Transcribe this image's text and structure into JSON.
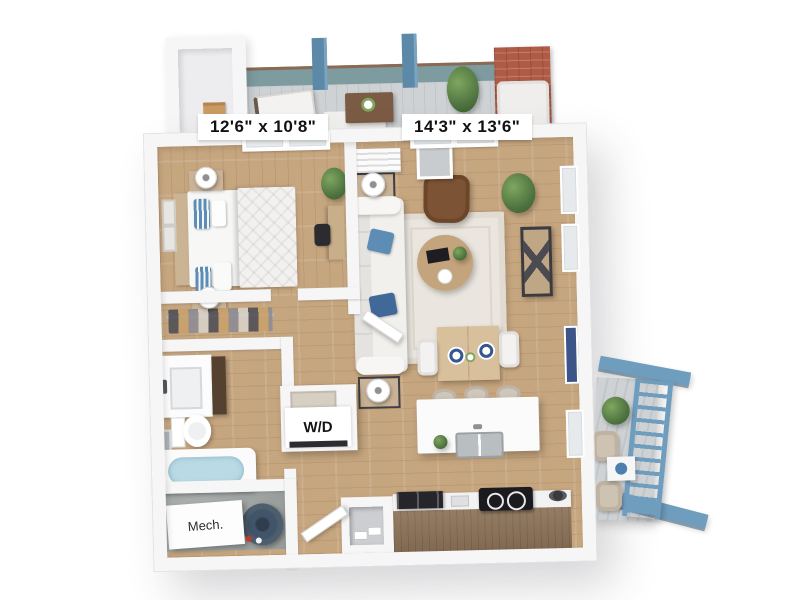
{
  "floorplan": {
    "labels": {
      "bedroom_dimensions": "12'6\" x 10'8\"",
      "living_room_dimensions": "14'3\" x 13'6\"",
      "washer_dryer": "W/D",
      "mechanical": "Mech."
    },
    "colors": {
      "wall": "#f6f6f7",
      "wood_floor": "#c6a67f",
      "balcony_deck": "#ced2d4",
      "accent_blue": "#6f9dbe",
      "post_blue": "#5d89a8",
      "teal_wall": "#7e9ca0",
      "brick_red": "#b05b45",
      "counter_wood": "#8c7258",
      "water_blue": "#badae5",
      "leather_brown": "#7c5334",
      "pillow_blue": "#5d8db4",
      "concrete": "#a3a8a6"
    }
  }
}
